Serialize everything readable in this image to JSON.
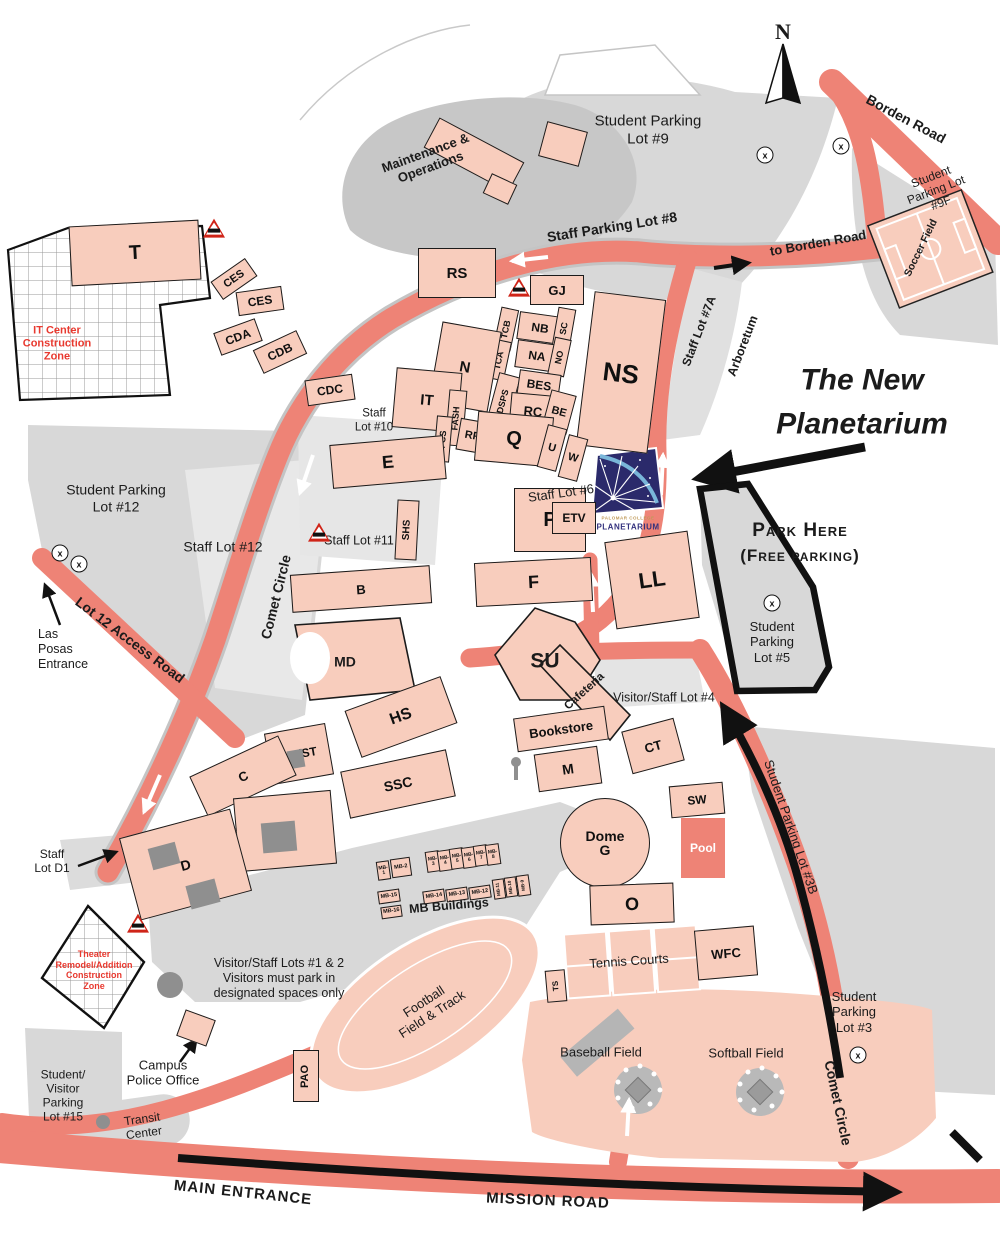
{
  "colors": {
    "road": "#ee8376",
    "building": "#f8cdbd",
    "lot_gray": "#d8d8d8",
    "route_black": "#111111",
    "construction_red": "#e8392f",
    "logo_navy": "#2b2a6b",
    "logo_blue": "#79b6d9",
    "logo_gold": "#c09a58"
  },
  "compass": {
    "n": "N"
  },
  "annotations": {
    "new_planetarium_1": "The New",
    "new_planetarium_2": "Planetarium",
    "park_here_1": "Park Here",
    "park_here_2": "(Free parking)"
  },
  "logo": {
    "college": "PALOMAR COLLEGE",
    "name": "PLANETARIUM"
  },
  "construction": {
    "it_zone": "IT Center\nConstruction\nZone",
    "theater_zone": "Theater\nRemodel/Addition\nConstruction\nZone"
  },
  "parking": {
    "lot9": "Student Parking\nLot #9",
    "lot9f": "Student Parking Lot\n#9F",
    "staff8": "Staff Parking Lot #8",
    "staff7a": "Staff Lot #7A",
    "lot5": "Student\nParking\nLot #5",
    "lot12": "Student Parking\nLot #12",
    "staff12": "Staff Lot #12",
    "staff11": "Staff Lot #11",
    "staff10": "Staff\nLot #10",
    "staff6": "Staff Lot #6",
    "lot4": "Visitor/Staff Lot #4",
    "lot3b": "Student Parking Lot #3B",
    "lot3": "Student\nParking\nLot #3",
    "staff_d1": "Staff\nLot D1",
    "lots_1_2_note": "Visitor/Staff Lots #1 & 2\nVisitors must park in\ndesignated spaces only",
    "lot15": "Student/\nVisitor\nParking\nLot #15",
    "x_marker": "x"
  },
  "roads": {
    "borden": "Borden Road",
    "to_borden": "to Borden Road",
    "comet_west": "Comet Circle",
    "comet_east": "Comet Circle",
    "lot12_access": "Lot 12 Access Road",
    "mission": "MISSION ROAD",
    "main_entrance": "MAIN ENTRANCE",
    "las_posas": "Las\nPosas\nEntrance",
    "arboretum": "Arboretum"
  },
  "places": {
    "maintenance": "Maintenance &\nOperations",
    "cafeteria": "Cafeteria",
    "bookstore": "Bookstore",
    "transit": "Transit\nCenter",
    "police": "Campus\nPolice Office",
    "mb_buildings": "MB Buildings",
    "soccer": "Soccer Field",
    "football": "Football\nField & Track",
    "tennis": "Tennis Courts",
    "baseball": "Baseball Field",
    "softball": "Softball Field"
  },
  "buildings": {
    "T": "T",
    "CES1": "CES",
    "CES2": "CES",
    "CDA": "CDA",
    "CDB": "CDB",
    "CDC": "CDC",
    "RS": "RS",
    "GJ": "GJ",
    "NS": "NS",
    "TCB": "TCB",
    "NB": "NB",
    "SC": "SC",
    "TCA": "TCA",
    "NA": "NA",
    "NO": "NO",
    "DSPS": "DSPS",
    "BES": "BES",
    "RC": "RC",
    "BE": "BE",
    "N": "N",
    "IT": "IT",
    "FASH": "FASH",
    "FCS": "FCS",
    "RF": "RF",
    "Q": "Q",
    "U": "U",
    "W": "W",
    "E": "E",
    "SHS": "SHS",
    "P": "P",
    "ETV": "ETV",
    "B": "B",
    "F": "F",
    "MD": "MD",
    "SU": "SU",
    "HS": "HS",
    "AAST": "AA/ST",
    "C": "C",
    "SSC": "SSC",
    "A": "A",
    "D": "D",
    "M": "M",
    "CT": "CT",
    "SW": "SW",
    "DOME": "Dome\nG",
    "POOL": "Pool",
    "O": "O",
    "WFC": "WFC",
    "TS": "TS",
    "PAO": "PAO",
    "LL": "LL",
    "MB1": "MB-1",
    "MB2": "MB-2",
    "MB3": "MB-3",
    "MB4": "MB-4",
    "MB5": "MB-5",
    "MB6": "MB-6",
    "MB7": "MB-7",
    "MB8": "MB-8",
    "MB9": "MB-9",
    "MB10": "MB-10",
    "MB11": "MB-11",
    "MB12": "MB-12",
    "MB13": "MB-13",
    "MB14": "MB-14",
    "MB15": "MB-15",
    "MB16": "MB-16"
  }
}
